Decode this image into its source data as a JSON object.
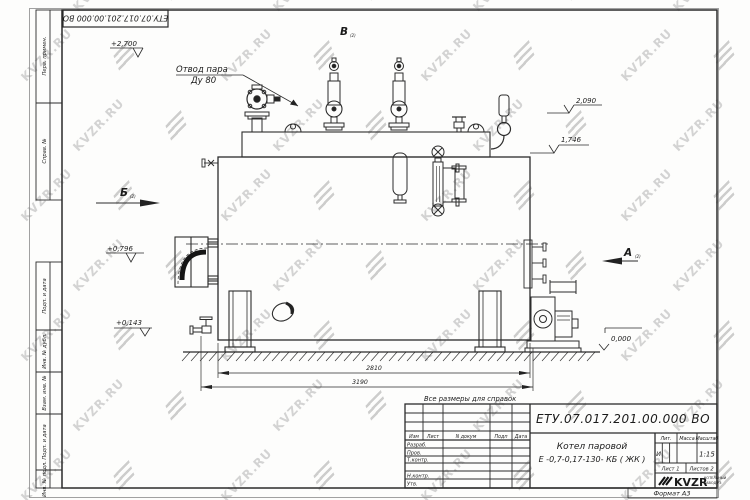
{
  "watermark": {
    "text": "KVZR.RU"
  },
  "stamp": {
    "doc_number": "ЕТУ.07.017.201.00.000  ВО"
  },
  "frame": {
    "side_labels": [
      "Перв. примен.",
      "Справ. №",
      "Подп. и дата",
      "Инв. № дубл.",
      "Взам. инв. №",
      "Подп. и дата",
      "Инв. № подл."
    ]
  },
  "drawing": {
    "callout": {
      "line1": "Отвод пара",
      "line2": "Ду 80"
    },
    "views": {
      "v": "В",
      "b": "Б",
      "a": "А",
      "sub": "(2)"
    },
    "elevations": {
      "e2700": "+2,700",
      "e2090": "2,090",
      "e1746": "1,746",
      "e0796": "+0,796",
      "e0143": "+0,143",
      "e0000": "0,000"
    },
    "dimensions": {
      "d1": "2810",
      "d2": "3190"
    },
    "note": "Все размеры для справок"
  },
  "title_block": {
    "doc_number": "ЕТУ.07.017.201.00.000  ВО",
    "product_name": "Котел паровой",
    "product_model": "Е -0,7-0,17-130- КБ ( ЖК )",
    "cols": [
      "Изм",
      "Лист",
      "N докум",
      "Подп",
      "Дата"
    ],
    "rows": [
      "Разраб.",
      "Пров.",
      "Т.контр.",
      "Н.контр.",
      "Утв."
    ],
    "lit_label": "Лит.",
    "mass_label": "Масса",
    "scale_label": "Масштаб",
    "lit_value": "И",
    "scale_value": "1:15",
    "sheet": "Лист 1",
    "sheets": "Листов 2",
    "logo": "KVZR",
    "logo_sub1": "КОТЕЛЬНЫЙ",
    "logo_sub2": "ЗАВОД РЗ",
    "format": "Формат А3"
  }
}
